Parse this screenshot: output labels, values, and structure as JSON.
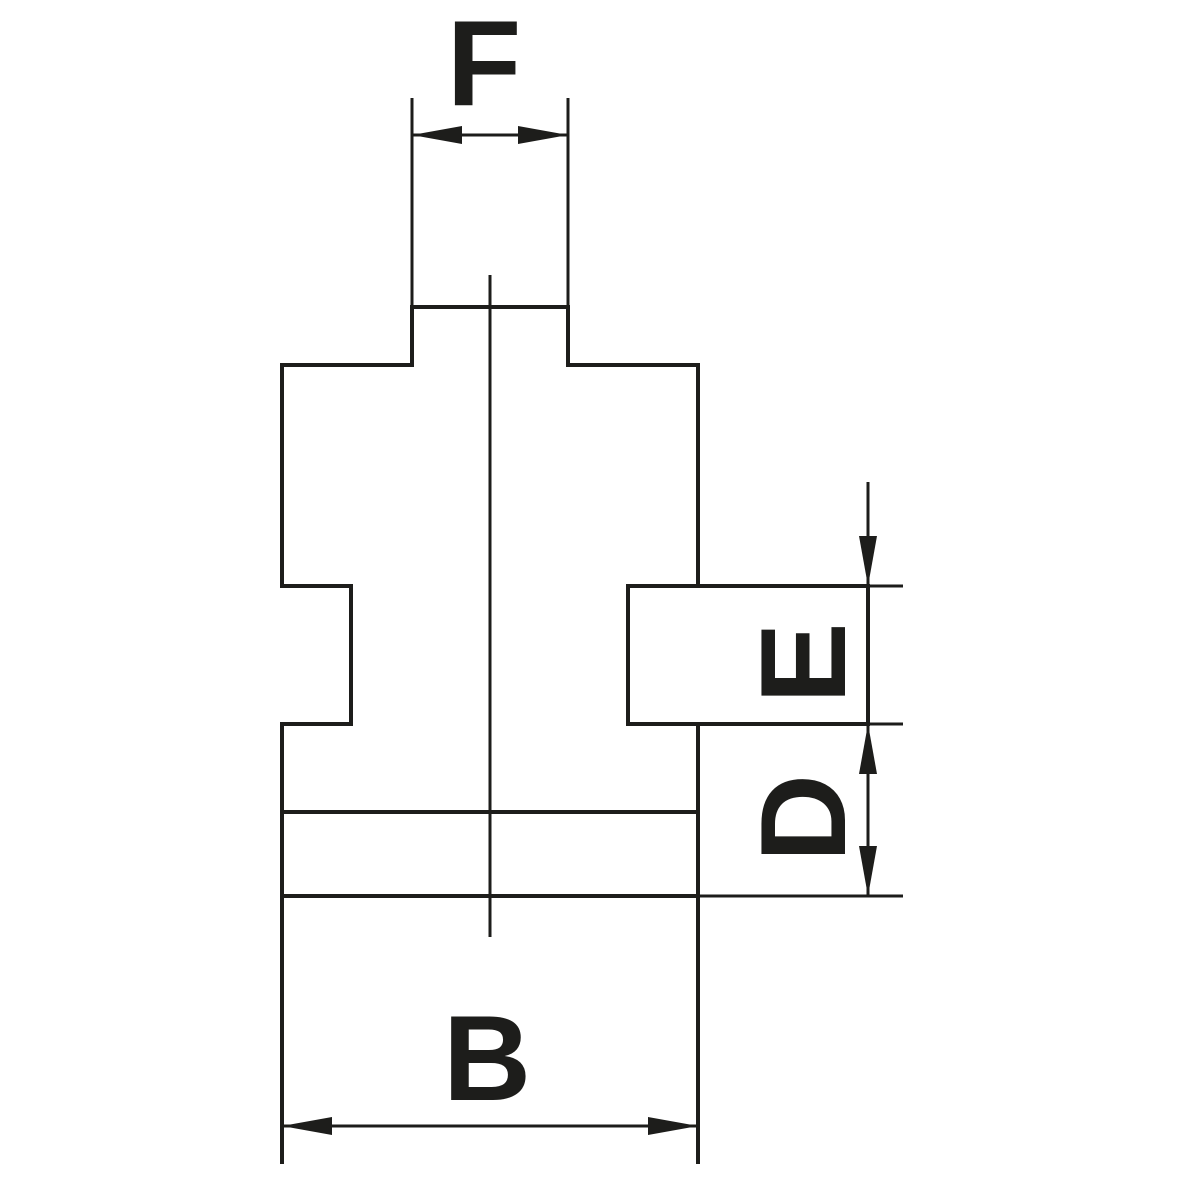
{
  "drawing": {
    "background_color": "#ffffff",
    "ink_color": "#1d1d1b",
    "canvas": {
      "width": 1200,
      "height": 1200
    },
    "stroke": {
      "outline": 4,
      "dimension": 3,
      "centerline": 3
    },
    "arrow": {
      "length": 50,
      "half_width": 9
    },
    "labels": [
      {
        "name": "dim-label-f",
        "text": "F",
        "x": 484,
        "y": 63,
        "rotation": 0,
        "font_size": 122
      },
      {
        "name": "dim-label-e",
        "text": "E",
        "x": 803,
        "y": 663,
        "rotation": -90,
        "font_size": 122
      },
      {
        "name": "dim-label-d",
        "text": "D",
        "x": 803,
        "y": 818,
        "rotation": -90,
        "font_size": 122
      },
      {
        "name": "dim-label-b",
        "text": "B",
        "x": 487,
        "y": 1058,
        "rotation": 0,
        "font_size": 122
      }
    ],
    "outline_segments": [
      {
        "name": "outline-top-edge",
        "x1": 412,
        "y1": 307,
        "x2": 568,
        "y2": 307
      },
      {
        "name": "outline-neck-left",
        "x1": 412,
        "y1": 307,
        "x2": 412,
        "y2": 365
      },
      {
        "name": "outline-neck-right",
        "x1": 568,
        "y1": 307,
        "x2": 568,
        "y2": 365
      },
      {
        "name": "outline-shoulder-left",
        "x1": 282,
        "y1": 365,
        "x2": 412,
        "y2": 365
      },
      {
        "name": "outline-shoulder-right",
        "x1": 568,
        "y1": 365,
        "x2": 698,
        "y2": 365
      },
      {
        "name": "outline-left-upper",
        "x1": 282,
        "y1": 365,
        "x2": 282,
        "y2": 586
      },
      {
        "name": "outline-notch-top",
        "x1": 282,
        "y1": 586,
        "x2": 351,
        "y2": 586
      },
      {
        "name": "outline-notch-inner",
        "x1": 351,
        "y1": 586,
        "x2": 351,
        "y2": 724
      },
      {
        "name": "outline-notch-bottom",
        "x1": 351,
        "y1": 724,
        "x2": 282,
        "y2": 724
      },
      {
        "name": "outline-left-lower",
        "x1": 282,
        "y1": 724,
        "x2": 282,
        "y2": 1162
      },
      {
        "name": "outline-right-upper",
        "x1": 698,
        "y1": 365,
        "x2": 698,
        "y2": 586
      },
      {
        "name": "outline-right-lower",
        "x1": 698,
        "y1": 724,
        "x2": 698,
        "y2": 1162
      },
      {
        "name": "outline-step-line",
        "x1": 282,
        "y1": 812,
        "x2": 698,
        "y2": 812
      },
      {
        "name": "outline-base-line",
        "x1": 282,
        "y1": 896,
        "x2": 698,
        "y2": 896
      },
      {
        "name": "key-block-top",
        "x1": 628,
        "y1": 586,
        "x2": 868,
        "y2": 586
      },
      {
        "name": "key-block-left",
        "x1": 628,
        "y1": 586,
        "x2": 628,
        "y2": 724
      },
      {
        "name": "key-block-bottom",
        "x1": 628,
        "y1": 724,
        "x2": 868,
        "y2": 724
      },
      {
        "name": "key-block-right",
        "x1": 868,
        "y1": 586,
        "x2": 868,
        "y2": 724
      }
    ],
    "dimension_segments": [
      {
        "name": "f-extension-left",
        "x1": 412,
        "y1": 98,
        "x2": 412,
        "y2": 307
      },
      {
        "name": "f-extension-right",
        "x1": 568,
        "y1": 98,
        "x2": 568,
        "y2": 307
      },
      {
        "name": "f-dimension-line",
        "x1": 412,
        "y1": 135,
        "x2": 568,
        "y2": 135
      },
      {
        "name": "ed-dimension-shaft",
        "x1": 868,
        "y1": 482,
        "x2": 868,
        "y2": 896
      },
      {
        "name": "e-extension-top",
        "x1": 868,
        "y1": 586,
        "x2": 903,
        "y2": 586
      },
      {
        "name": "e-extension-bottom",
        "x1": 868,
        "y1": 724,
        "x2": 903,
        "y2": 724
      },
      {
        "name": "d-extension-bottom",
        "x1": 698,
        "y1": 896,
        "x2": 903,
        "y2": 896
      },
      {
        "name": "b-dimension-line",
        "x1": 282,
        "y1": 1126,
        "x2": 698,
        "y2": 1126
      }
    ],
    "centerline_segments": [
      {
        "name": "part-centerline",
        "x1": 490,
        "y1": 275,
        "x2": 490,
        "y2": 937
      }
    ],
    "arrowheads": [
      {
        "name": "f-arrow-left",
        "x": 412,
        "y": 135,
        "dir": "left"
      },
      {
        "name": "f-arrow-right",
        "x": 568,
        "y": 135,
        "dir": "right"
      },
      {
        "name": "e-arrow-top",
        "x": 868,
        "y": 586,
        "dir": "down"
      },
      {
        "name": "ed-arrow-middle",
        "x": 868,
        "y": 724,
        "dir": "up"
      },
      {
        "name": "d-arrow-bottom",
        "x": 868,
        "y": 896,
        "dir": "down"
      },
      {
        "name": "b-arrow-left",
        "x": 282,
        "y": 1126,
        "dir": "left"
      },
      {
        "name": "b-arrow-right",
        "x": 698,
        "y": 1126,
        "dir": "right"
      }
    ]
  }
}
